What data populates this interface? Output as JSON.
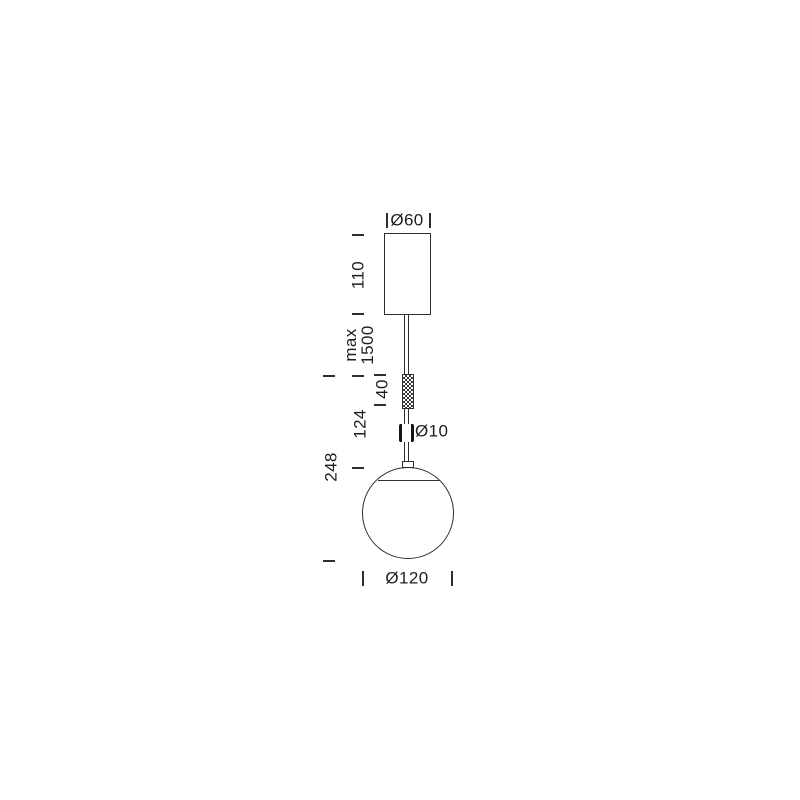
{
  "canvas": {
    "background": "#ffffff",
    "line_color": "#2e2e2e",
    "text_color": "#1e1e1e"
  },
  "labels": {
    "canopy_diameter": "Ø60",
    "canopy_height": "110",
    "cable_max_length": "max\n1500",
    "grip_height": "40",
    "stem_length": "124",
    "stem_diameter": "Ø10",
    "drop_section_height": "248",
    "globe_diameter": "Ø120"
  }
}
